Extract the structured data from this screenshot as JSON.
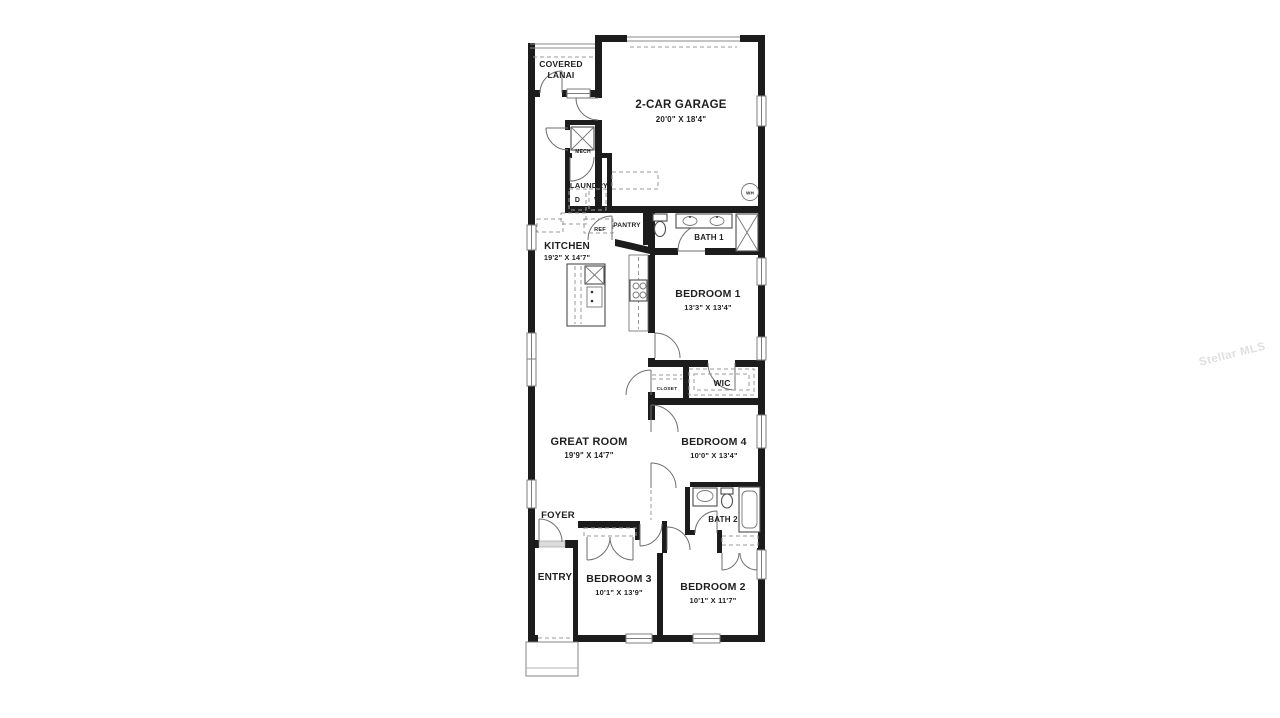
{
  "colors": {
    "wall": "#1c1c1c",
    "watermark_text": "rgba(0,0,0,0.13)"
  },
  "watermark": "Stellar MLS",
  "rooms": {
    "covered_lanai": {
      "line1": "COVERED",
      "line2": "LANAI"
    },
    "garage": {
      "name": "2-CAR GARAGE",
      "dims": "20'0\" X 18'4\""
    },
    "mech": {
      "name": "MECH"
    },
    "laundry": {
      "name": "LAUNDRY",
      "dryer": "D",
      "washer": "W"
    },
    "ref": {
      "name": "REF"
    },
    "pantry": {
      "name": "PANTRY"
    },
    "bath1": {
      "name": "BATH 1"
    },
    "kitchen": {
      "name": "KITCHEN",
      "dims": "19'2\" X 14'7\""
    },
    "bedroom1": {
      "name": "BEDROOM 1",
      "dims": "13'3\" X 13'4\""
    },
    "wic": {
      "name": "WIC"
    },
    "closet": {
      "name": "CLOSET"
    },
    "great_room": {
      "name": "GREAT ROOM",
      "dims": "19'9\" X 14'7\""
    },
    "bedroom4": {
      "name": "BEDROOM 4",
      "dims": "10'0\" X 13'4\""
    },
    "bath2": {
      "name": "BATH 2"
    },
    "foyer": {
      "name": "FOYER"
    },
    "entry": {
      "name": "ENTRY"
    },
    "bedroom3": {
      "name": "BEDROOM 3",
      "dims": "10'1\" X 13'9\""
    },
    "bedroom2": {
      "name": "BEDROOM 2",
      "dims": "10'1\" X 11'7\""
    },
    "water_heater": {
      "abbr": "WH"
    }
  }
}
